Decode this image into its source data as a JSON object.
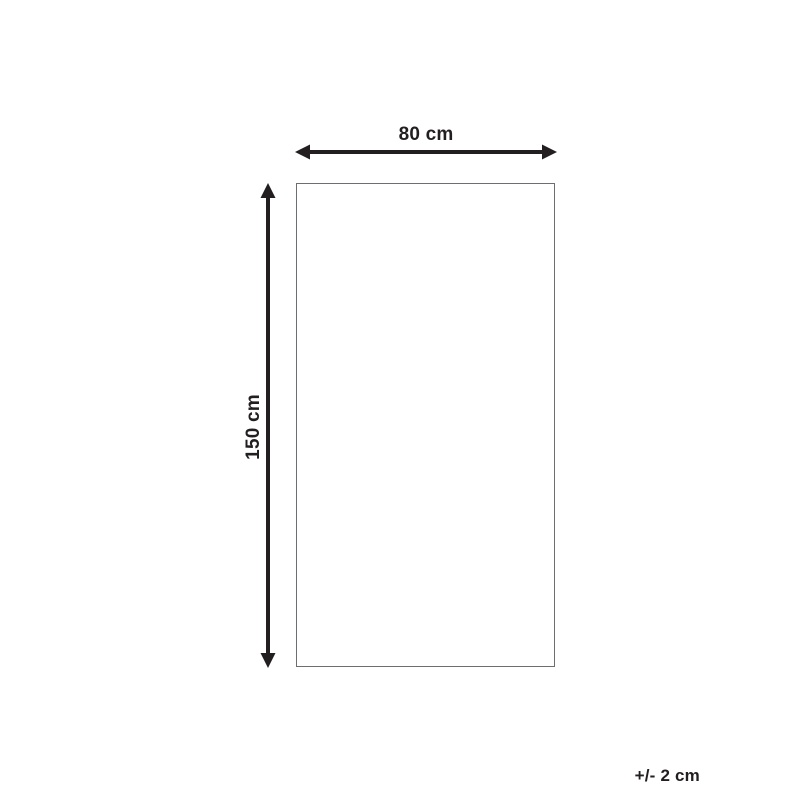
{
  "diagram": {
    "type": "product-dimension-diagram",
    "width_label": "80 cm",
    "height_label": "150 cm",
    "tolerance_label": "+/- 2 cm",
    "colors": {
      "arrow": "#231f20",
      "text": "#231f20",
      "rectangle_border": "#6d6e71",
      "background": "#ffffff"
    }
  }
}
